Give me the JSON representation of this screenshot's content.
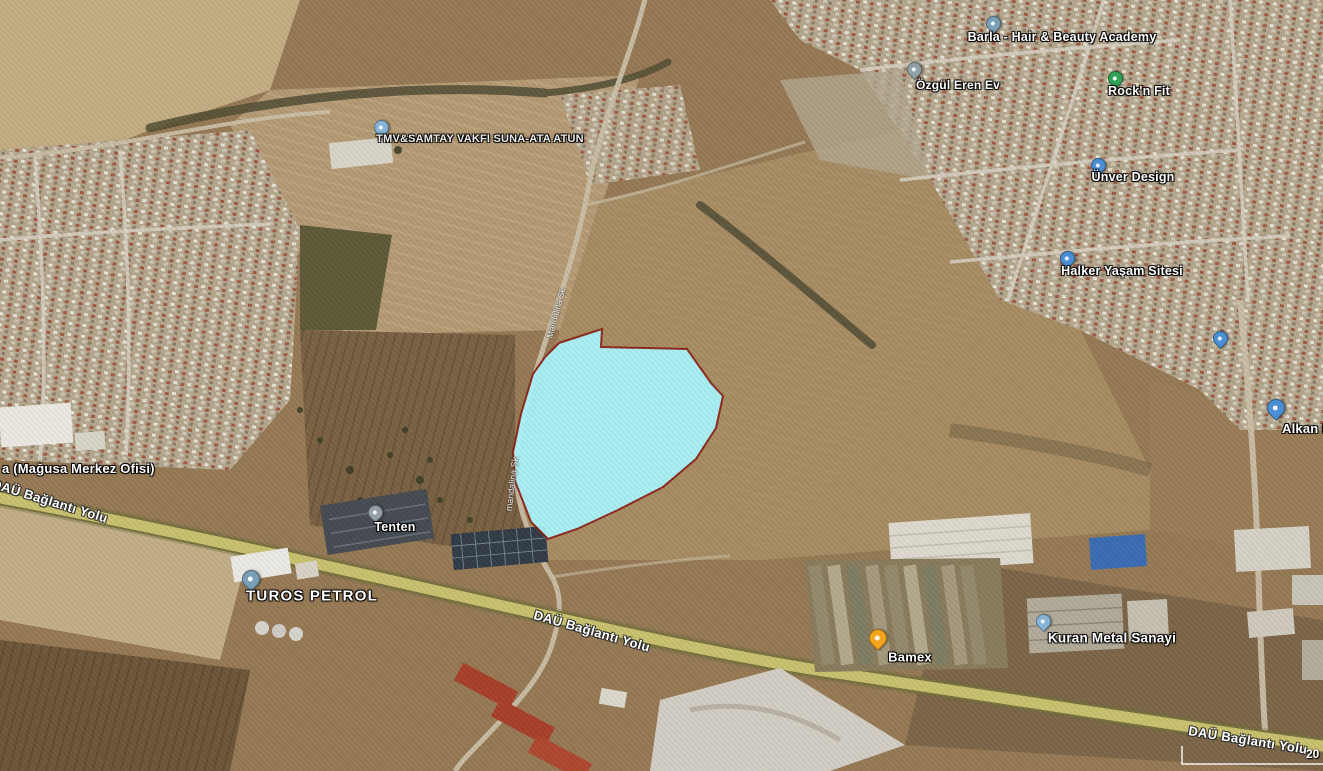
{
  "map": {
    "parcel": {
      "points": "559,343 602,329 601,347 687,349 711,383 723,396 716,428 696,459 663,487 618,510 577,529 548,539 531,522 515,481 513,452 521,414 533,374 545,357",
      "fill": "#a9f6fd",
      "stroke": "#8b1a10"
    },
    "scale_label": "20",
    "labels": {
      "barla": "Barla - Hair & Beauty Academy",
      "ozgul": "Özgül Eren Ev",
      "rocknfit": "Rock'n Fit",
      "unver": "Ünver Design",
      "halker": "Halker Yaşam Sitesi",
      "alkan": "Alkan M",
      "tmv": "TMV&SAMTAY VAKFI SUNA-ATA ATUN",
      "magusa": "a (Mağusa Merkez Ofisi)",
      "turos": "TUROS PETROL",
      "tenten": "Tenten",
      "bamex": "Bamex",
      "kuran": "Kuran Metal Sanayi",
      "road_left": "DAÜ Bağlantı Yolu",
      "road_center": "DAÜ Bağlantı Yolu",
      "road_right": "DAÜ Bağlantı Yolu",
      "street_upper": "Mandalina Sk",
      "street_lower": "mandalina Sk"
    },
    "pin_colors": {
      "blue": "#4a8fd4",
      "steel": "#7aa0b8",
      "gray": "#93a0a8",
      "green": "#2fa256",
      "orange": "#f2a51d",
      "lightblue": "#86b4d6"
    }
  }
}
